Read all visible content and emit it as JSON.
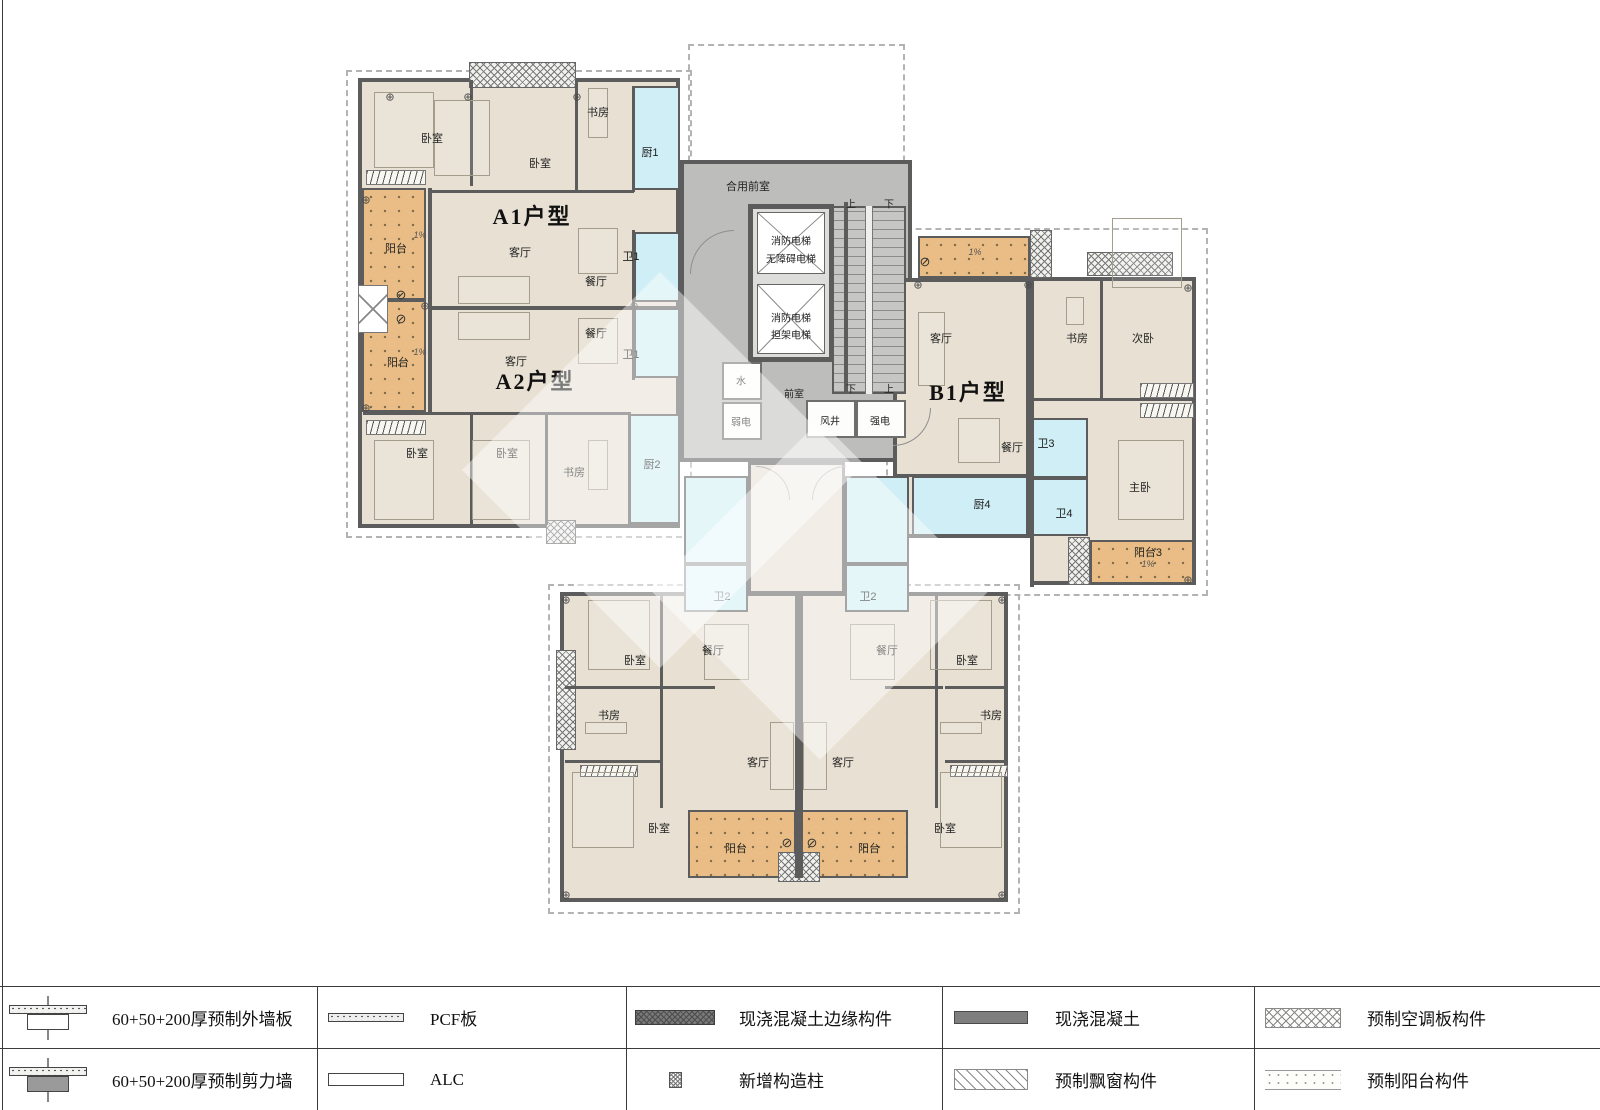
{
  "plan": {
    "units": [
      "A1户型",
      "A2户型",
      "B1户型"
    ],
    "labels": [
      {
        "t": "A1户型",
        "x": 532,
        "y": 215,
        "k": "u"
      },
      {
        "t": "A2户型",
        "x": 535,
        "y": 380,
        "k": "u"
      },
      {
        "t": "B1户型",
        "x": 968,
        "y": 391,
        "k": "u"
      },
      {
        "t": "卧室",
        "x": 432,
        "y": 138,
        "k": "r"
      },
      {
        "t": "卧室",
        "x": 540,
        "y": 163,
        "k": "r"
      },
      {
        "t": "书房",
        "x": 598,
        "y": 112,
        "k": "r"
      },
      {
        "t": "厨1",
        "x": 650,
        "y": 152,
        "k": "r"
      },
      {
        "t": "阳台",
        "x": 396,
        "y": 248,
        "k": "r"
      },
      {
        "t": "客厅",
        "x": 520,
        "y": 252,
        "k": "r"
      },
      {
        "t": "餐厅",
        "x": 596,
        "y": 281,
        "k": "r"
      },
      {
        "t": "卫1",
        "x": 631,
        "y": 256,
        "k": "r"
      },
      {
        "t": "餐厅",
        "x": 596,
        "y": 333,
        "k": "r"
      },
      {
        "t": "客厅",
        "x": 516,
        "y": 361,
        "k": "r"
      },
      {
        "t": "阳台",
        "x": 398,
        "y": 362,
        "k": "r"
      },
      {
        "t": "卫1",
        "x": 631,
        "y": 354,
        "k": "r"
      },
      {
        "t": "卧室",
        "x": 417,
        "y": 453,
        "k": "r"
      },
      {
        "t": "卧室",
        "x": 507,
        "y": 453,
        "k": "r"
      },
      {
        "t": "书房",
        "x": 574,
        "y": 472,
        "k": "r"
      },
      {
        "t": "厨2",
        "x": 652,
        "y": 464,
        "k": "r"
      },
      {
        "t": "合用前室",
        "x": 748,
        "y": 186,
        "k": "r"
      },
      {
        "t": "消防电梯",
        "x": 791,
        "y": 240,
        "k": "s"
      },
      {
        "t": "无障碍电梯",
        "x": 791,
        "y": 258,
        "k": "s"
      },
      {
        "t": "消防电梯",
        "x": 791,
        "y": 317,
        "k": "s"
      },
      {
        "t": "担架电梯",
        "x": 791,
        "y": 334,
        "k": "s"
      },
      {
        "t": "上",
        "x": 851,
        "y": 203,
        "k": "s"
      },
      {
        "t": "下",
        "x": 889,
        "y": 203,
        "k": "s"
      },
      {
        "t": "下",
        "x": 851,
        "y": 388,
        "k": "s"
      },
      {
        "t": "上",
        "x": 889,
        "y": 388,
        "k": "s"
      },
      {
        "t": "水",
        "x": 741,
        "y": 380,
        "k": "s"
      },
      {
        "t": "弱电",
        "x": 741,
        "y": 421,
        "k": "s"
      },
      {
        "t": "前室",
        "x": 794,
        "y": 393,
        "k": "s"
      },
      {
        "t": "风井",
        "x": 830,
        "y": 420,
        "k": "s"
      },
      {
        "t": "强电",
        "x": 880,
        "y": 420,
        "k": "s"
      },
      {
        "t": "客厅",
        "x": 941,
        "y": 338,
        "k": "r"
      },
      {
        "t": "书房",
        "x": 1077,
        "y": 338,
        "k": "r"
      },
      {
        "t": "次卧",
        "x": 1143,
        "y": 338,
        "k": "r"
      },
      {
        "t": "餐厅",
        "x": 1012,
        "y": 447,
        "k": "r"
      },
      {
        "t": "卫3",
        "x": 1046,
        "y": 443,
        "k": "r"
      },
      {
        "t": "厨4",
        "x": 982,
        "y": 504,
        "k": "r"
      },
      {
        "t": "卫4",
        "x": 1064,
        "y": 513,
        "k": "r"
      },
      {
        "t": "主卧",
        "x": 1140,
        "y": 487,
        "k": "r"
      },
      {
        "t": "阳台3",
        "x": 1148,
        "y": 552,
        "k": "r"
      },
      {
        "t": "卫2",
        "x": 722,
        "y": 596,
        "k": "r"
      },
      {
        "t": "卫2",
        "x": 868,
        "y": 596,
        "k": "r"
      },
      {
        "t": "餐厅",
        "x": 713,
        "y": 650,
        "k": "r"
      },
      {
        "t": "餐厅",
        "x": 887,
        "y": 650,
        "k": "r"
      },
      {
        "t": "卧室",
        "x": 635,
        "y": 660,
        "k": "r"
      },
      {
        "t": "卧室",
        "x": 967,
        "y": 660,
        "k": "r"
      },
      {
        "t": "书房",
        "x": 609,
        "y": 715,
        "k": "r"
      },
      {
        "t": "书房",
        "x": 991,
        "y": 715,
        "k": "r"
      },
      {
        "t": "客厅",
        "x": 758,
        "y": 762,
        "k": "r"
      },
      {
        "t": "客厅",
        "x": 843,
        "y": 762,
        "k": "r"
      },
      {
        "t": "卧室",
        "x": 659,
        "y": 828,
        "k": "r"
      },
      {
        "t": "卧室",
        "x": 945,
        "y": 828,
        "k": "r"
      },
      {
        "t": "阳台",
        "x": 736,
        "y": 848,
        "k": "r"
      },
      {
        "t": "阳台",
        "x": 869,
        "y": 848,
        "k": "r"
      },
      {
        "t": "1%",
        "x": 420,
        "y": 235,
        "k": "p"
      },
      {
        "t": "1%",
        "x": 420,
        "y": 352,
        "k": "p"
      },
      {
        "t": "1%",
        "x": 975,
        "y": 252,
        "k": "p"
      },
      {
        "t": "1%",
        "x": 1148,
        "y": 564,
        "k": "p"
      },
      {
        "t": "⊘",
        "x": 401,
        "y": 295,
        "k": "d"
      },
      {
        "t": "⊘",
        "x": 401,
        "y": 319,
        "k": "d"
      },
      {
        "t": "⊘",
        "x": 925,
        "y": 262,
        "k": "d"
      },
      {
        "t": "⊘",
        "x": 787,
        "y": 843,
        "k": "d"
      },
      {
        "t": "⊘",
        "x": 812,
        "y": 843,
        "k": "d"
      }
    ]
  },
  "legend": {
    "columns": [
      {
        "rows": [
          {
            "icon": "exterior-wall-section",
            "label": "60+50+200厚预制外墙板"
          },
          {
            "icon": "shear-wall-section",
            "label": "60+50+200厚预制剪力墙"
          }
        ]
      },
      {
        "rows": [
          {
            "icon": "pcf-swatch",
            "label": "PCF板"
          },
          {
            "icon": "alc-swatch",
            "label": "ALC"
          }
        ]
      },
      {
        "rows": [
          {
            "icon": "cast-edge-swatch",
            "label": "现浇混凝土边缘构件"
          },
          {
            "icon": "new-column-swatch",
            "label": "新增构造柱"
          }
        ]
      },
      {
        "rows": [
          {
            "icon": "cast-concrete-swatch",
            "label": "现浇混凝土"
          },
          {
            "icon": "bay-window-swatch",
            "label": "预制飘窗构件"
          }
        ]
      },
      {
        "rows": [
          {
            "icon": "ac-panel-swatch",
            "label": "预制空调板构件"
          },
          {
            "icon": "balcony-member-swatch",
            "label": "预制阳台构件"
          }
        ]
      }
    ]
  },
  "colors": {
    "floor_beige": "#e8e1d3",
    "wet_cyan": "#cfeef5",
    "balcony_orange": "#e9bd85",
    "core_gray": "#bdbdbb",
    "wall_gray": "#5c5c5c"
  }
}
